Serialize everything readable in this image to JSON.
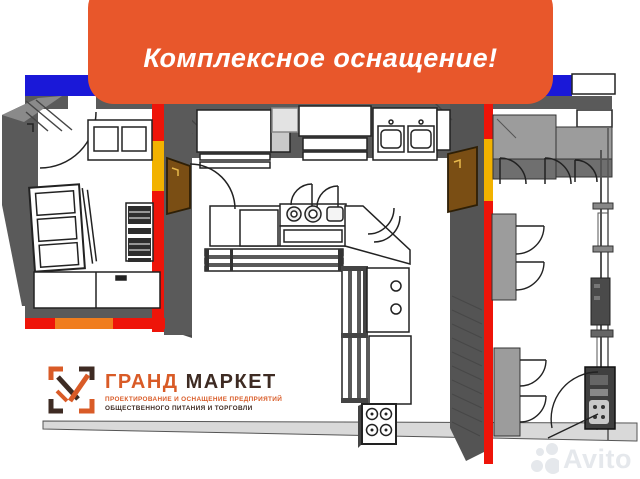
{
  "banner": {
    "text": "Комплексное оснащение!"
  },
  "logo": {
    "name_primary": "ГРАНД",
    "name_secondary": "МАРКЕТ",
    "tagline_line1": "ПРОЕКТИРОВАНИЕ И ОСНАЩЕНИЕ ПРЕДПРИЯТИЙ",
    "tagline_line2": "ОБЩЕСТВЕННОГО ПИТАНИЯ И ТОРГОВЛИ"
  },
  "watermark": {
    "text": "Avito"
  },
  "icons": {
    "logo_mark": "grand-market-bracket-check-icon",
    "watermark_mark": "avito-circles-icon"
  },
  "colors": {
    "banner_orange": "#E8572B",
    "stripe_blue": "#1A18D8",
    "wall_red": "#EE1409",
    "wall_yellow": "#F2B200",
    "wall_orange": "#F07D1E",
    "wall_gray": "#5A5A5A",
    "cabinet_gray": "#9C9C9C",
    "door_brown": "#7A4E14",
    "floor_gray": "#D9D9D9",
    "logo_orange": "#D95B27",
    "logo_dark": "#3E2B23",
    "watermark_gray": "#E3E6EA"
  }
}
